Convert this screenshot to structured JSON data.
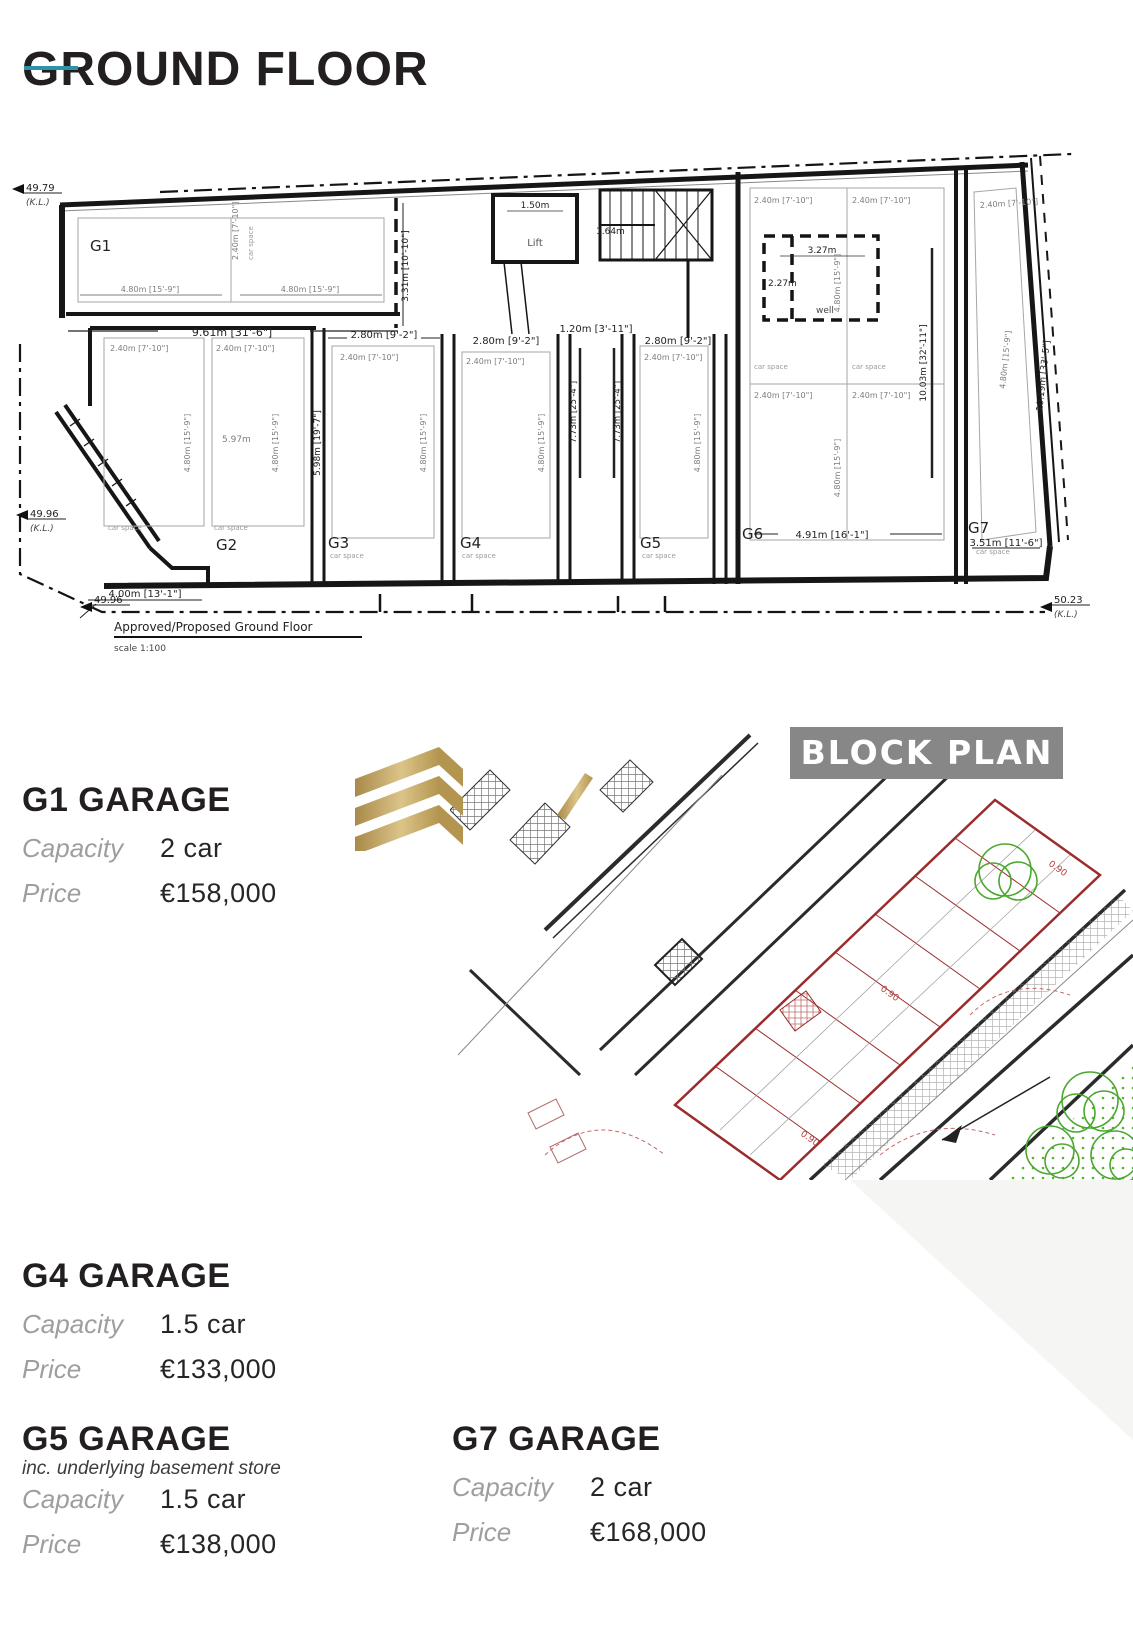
{
  "page": {
    "title": "GROUND FLOOR"
  },
  "floor_plan": {
    "caption": "Approved/Proposed Ground Floor",
    "scale_note": "scale 1:100",
    "rooms": {
      "g1": "G1",
      "g2": "G2",
      "g3": "G3",
      "g4": "G4",
      "g5": "G5",
      "g6": "G6",
      "g7": "G7",
      "lift": "Lift",
      "well": "well",
      "car_space": "car space"
    },
    "levels": {
      "v1": "49.79",
      "v2": "49.96",
      "v3": "49.96",
      "v4": "50.23",
      "kl": "(K.L.)"
    },
    "dims": {
      "d961": "9.61m [31'-6\"]",
      "d480": "4.80m [15'-9\"]",
      "d240": "2.40m [7'-10\"]",
      "d280": "2.80m [9'-2\"]",
      "d120": "1.20m [3'-11\"]",
      "d150": "1.50m",
      "d164": "1.64m",
      "d327": "3.27m",
      "d227": "2.27m",
      "d331": "3.31m [10'-10\"]",
      "d400": "4.00m [13'-1\"]",
      "d491": "4.91m [16'-1\"]",
      "d351": "3.51m [11'-6\"]",
      "d597": "5.97m",
      "d598": "5.98m [19'-7\"]",
      "d773": "7.73m [25'-4\"]",
      "d1003": "10.03m [32'-11\"]",
      "d1019": "10.19m [33'-5\"]"
    }
  },
  "block_plan": {
    "banner": "BLOCK PLAN",
    "stall_dim": "0.90"
  },
  "listings": [
    {
      "title": "G1 GARAGE",
      "capacity_label": "Capacity",
      "capacity": "2 car",
      "price_label": "Price",
      "price": "€158,000"
    },
    {
      "title": "G4 GARAGE",
      "capacity_label": "Capacity",
      "capacity": "1.5 car",
      "price_label": "Price",
      "price": "€133,000"
    },
    {
      "title": "G5 GARAGE",
      "note": "inc. underlying basement store",
      "capacity_label": "Capacity",
      "capacity": "1.5 car",
      "price_label": "Price",
      "price": "€138,000"
    },
    {
      "title": "G7 GARAGE",
      "capacity_label": "Capacity",
      "capacity": "2 car",
      "price_label": "Price",
      "price": "€168,000"
    }
  ]
}
